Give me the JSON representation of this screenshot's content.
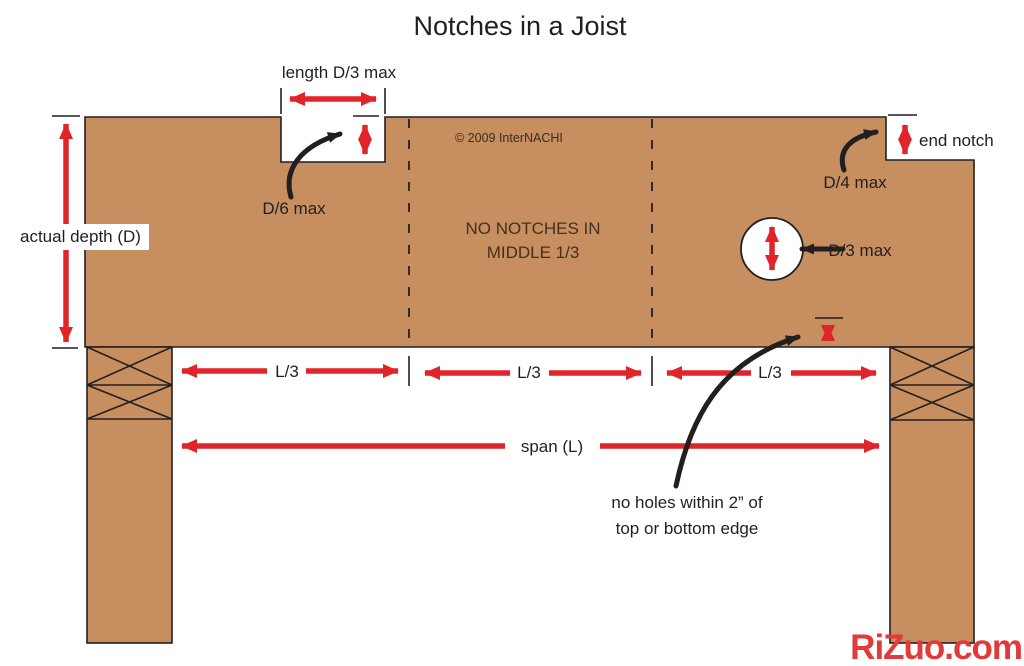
{
  "title": "Notches in a Joist",
  "copyright": "© 2009  InterNACHI",
  "watermark": "RiZuo.com",
  "colors": {
    "wood": "#c78e5f",
    "outline": "#231f20",
    "dimension_red": "#e02429",
    "notice_text": "#45301d",
    "watermark_red": "#e23a3a",
    "background": "#ffffff"
  },
  "labels": {
    "notch_length": "length D/3 max",
    "notch_depth": "D/6 max",
    "actual_depth": "actual depth (D)",
    "no_notches_line1": "NO NOTCHES IN",
    "no_notches_line2": "MIDDLE 1/3",
    "end_notch": "end notch",
    "end_notch_depth": "D/4 max",
    "hole_diameter": "D/3 max",
    "third_left": "L/3",
    "third_middle": "L/3",
    "third_right": "L/3",
    "span": "span (L)",
    "hole_clearance_line1": "no holes within 2” of",
    "hole_clearance_line2": "top or bottom edge"
  }
}
